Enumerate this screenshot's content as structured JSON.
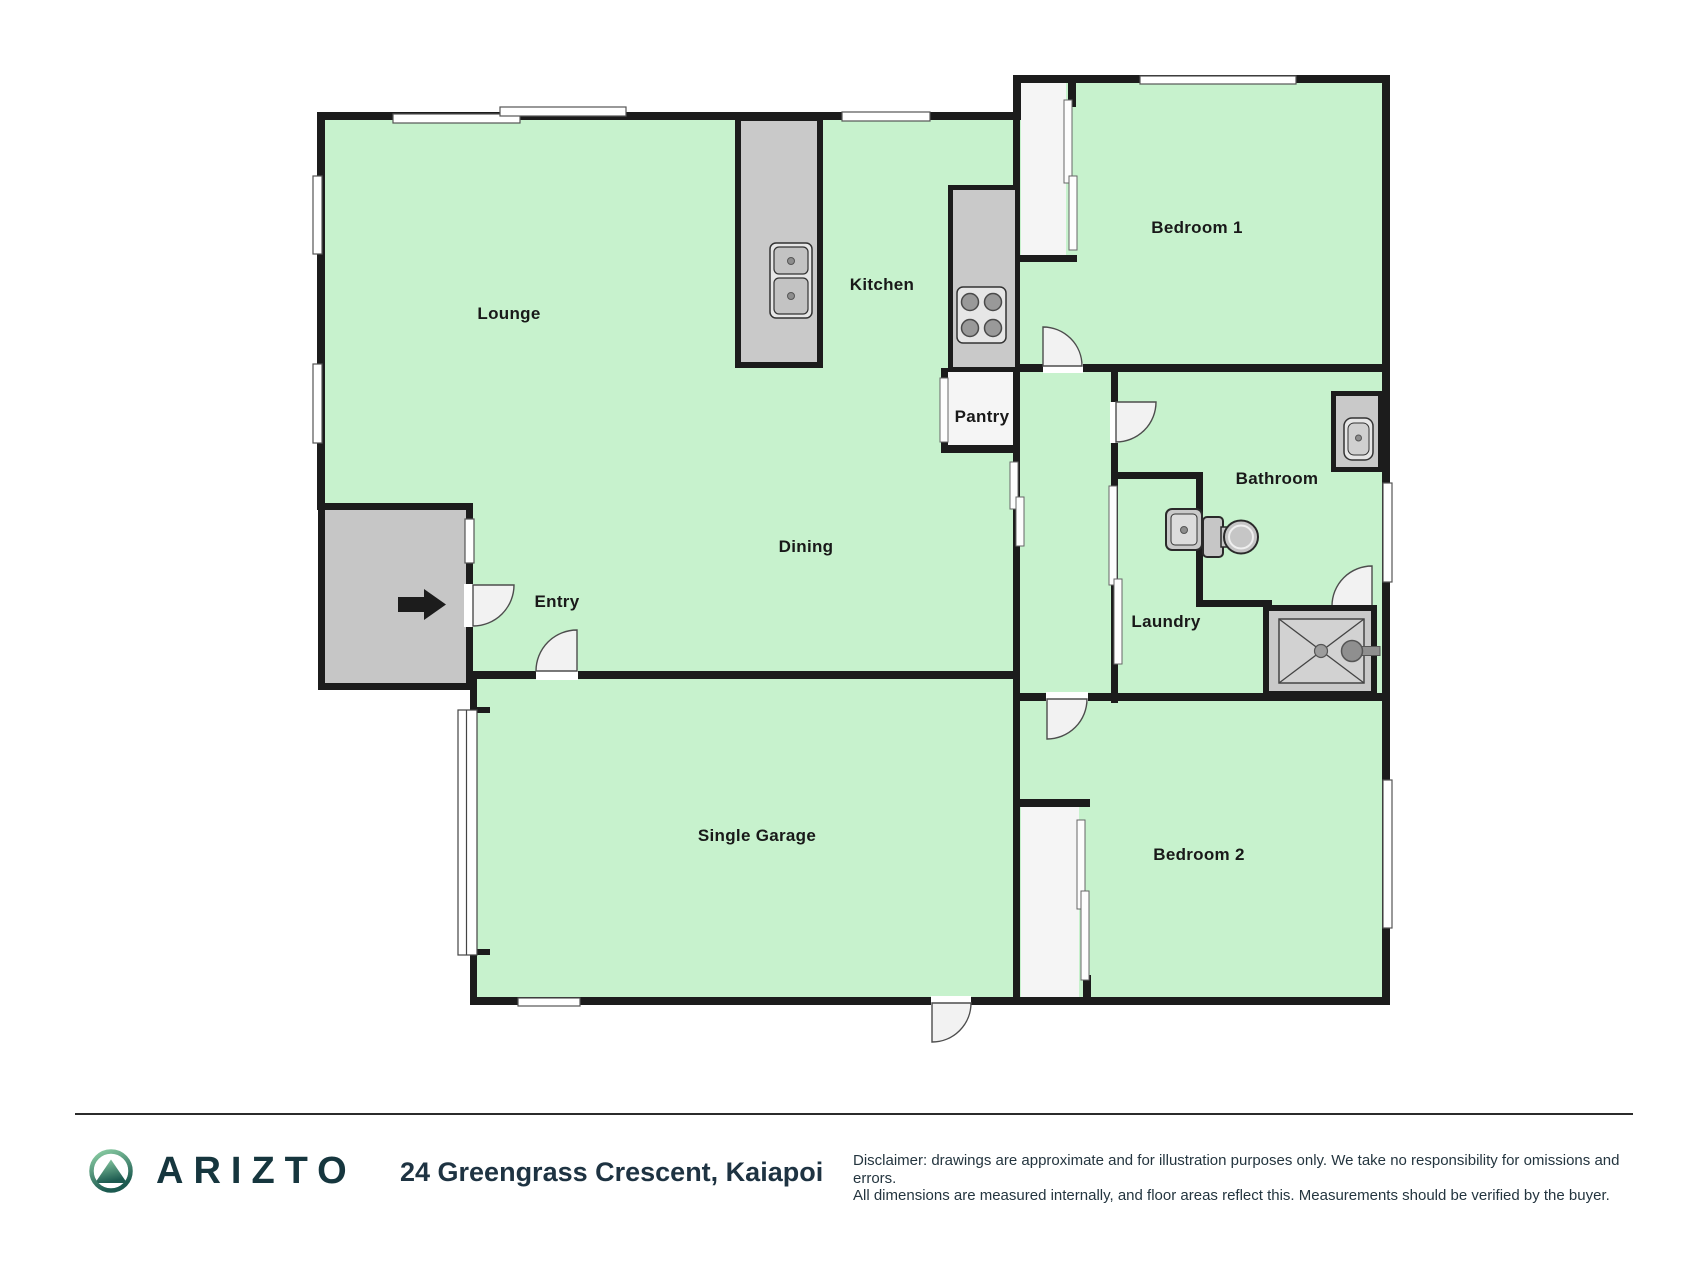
{
  "floorplan": {
    "rooms": {
      "lounge": "Lounge",
      "kitchen": "Kitchen",
      "pantry": "Pantry",
      "dining": "Dining",
      "entry": "Entry",
      "bedroom1": "Bedroom 1",
      "bathroom": "Bathroom",
      "laundry": "Laundry",
      "garage": "Single Garage",
      "bedroom2": "Bedroom 2"
    },
    "fixtures": [
      "kitchen-island-double-sink",
      "cooktop-four-burners",
      "bathroom-vanity-sink",
      "laundry-tub",
      "toilet",
      "shower",
      "garage-roller-door",
      "entry-direction-arrow"
    ],
    "colors": {
      "floor_green": "#c7f2cd",
      "wall_black": "#1c1c1c",
      "fixture_gray": "#c9c9c9",
      "porch_gray": "#c6c6c6",
      "white_area": "#f5f5f5",
      "door_arc": "#f2f2f2"
    }
  },
  "footer": {
    "brand": "ARIZTO",
    "address": "24 Greengrass Crescent, Kaiapoi",
    "disclaimer_line1": "Disclaimer: drawings are approximate and for illustration purposes only. We take no responsibility for omissions and errors.",
    "disclaimer_line2": "All dimensions are measured internally, and floor areas reflect this. Measurements should be verified by the buyer.",
    "brand_color": "#16363e",
    "footer_text_color": "#24353f",
    "logo_green_light": "#8ed1a6",
    "logo_green_dark": "#1c5a50"
  }
}
